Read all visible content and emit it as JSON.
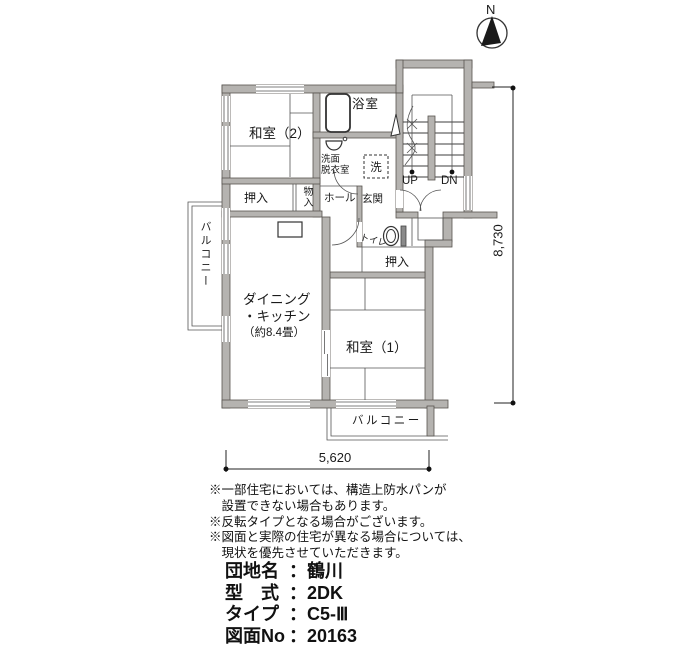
{
  "compass": {
    "north": "N"
  },
  "plan": {
    "rooms": {
      "washitsu2": "和室（2）",
      "washitsu1": "和室（1）",
      "bath": "浴室",
      "washroom1": "洗面",
      "washroom2": "脱衣室",
      "laundry": "洗",
      "hall": "ホール",
      "genkan": "玄関",
      "toilet": "トイレ",
      "closet_upper": "押入",
      "closet_lower": "押入",
      "storage": "物入",
      "dk1": "ダイニング",
      "dk2": "・キッチン",
      "dk3": "（約8.4畳）",
      "balcony_left": "バルコニー",
      "balcony_bottom": "バルコニー"
    },
    "stairs": {
      "up": "UP",
      "down": "DN"
    },
    "dimensions": {
      "width": "5,620",
      "height": "8,730"
    }
  },
  "notes": {
    "lines": [
      "※一部住宅においては、構造上防水パンが",
      "　設置できない場合もあります。",
      "※反転タイプとなる場合がございます。",
      "※図面と実際の住宅が異なる場合については、",
      "　現状を優先させていただきます。"
    ]
  },
  "info": {
    "separator": "：",
    "rows": [
      {
        "label": "団地名",
        "value": "鶴川"
      },
      {
        "label": "型　式",
        "value": "2DK"
      },
      {
        "label": "タイプ",
        "value": "C5-Ⅲ"
      },
      {
        "label": "図面No",
        "value": "20163"
      }
    ]
  },
  "colors": {
    "wall_fill": "#b5b3b0",
    "line": "#3c3c3c",
    "text": "#1a1a1a"
  }
}
